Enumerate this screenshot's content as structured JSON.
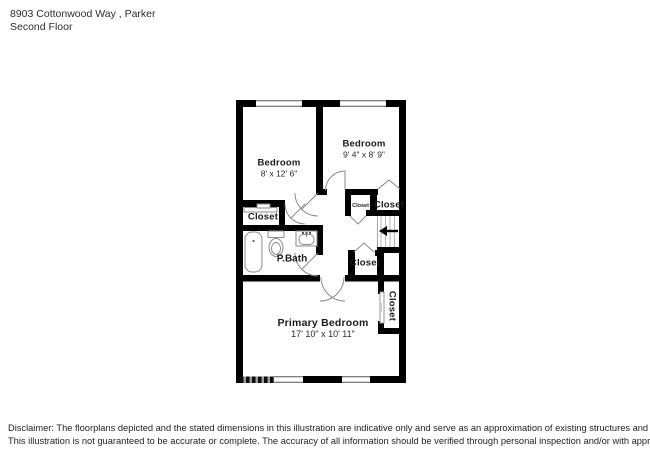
{
  "header": {
    "address": "8903 Cottonwood Way , Parker",
    "floor": "Second Floor"
  },
  "rooms": {
    "bedroom_left": {
      "name": "Bedroom",
      "dims": "8' x 12' 6\""
    },
    "bedroom_right": {
      "name": "Bedroom",
      "dims": "9' 4\" x 8' 9\""
    },
    "primary_bedroom": {
      "name": "Primary Bedroom",
      "dims": "17' 10\" x 10' 11\""
    },
    "bath": {
      "name": "P.Bath"
    },
    "closet_left": {
      "name": "Closet"
    },
    "closet_small": {
      "name": "Closet"
    },
    "closet_top_right": {
      "name": "Closet"
    },
    "closet_mid": {
      "name": "Closet"
    },
    "closet_primary": {
      "name": "Closet"
    }
  },
  "disclaimer": {
    "line1": "Disclaimer: The floorplans depicted and the stated dimensions in this illustration are indicative only and serve as an approximation of existing structures and features.",
    "line2": "This illustration is not guaranteed to be accurate or complete. The accuracy of all information should be verified through personal inspection and/or with appropriate professionals."
  },
  "colors": {
    "wall": "#000000",
    "fixture_stroke": "#8a8a8a",
    "background": "#ffffff"
  }
}
